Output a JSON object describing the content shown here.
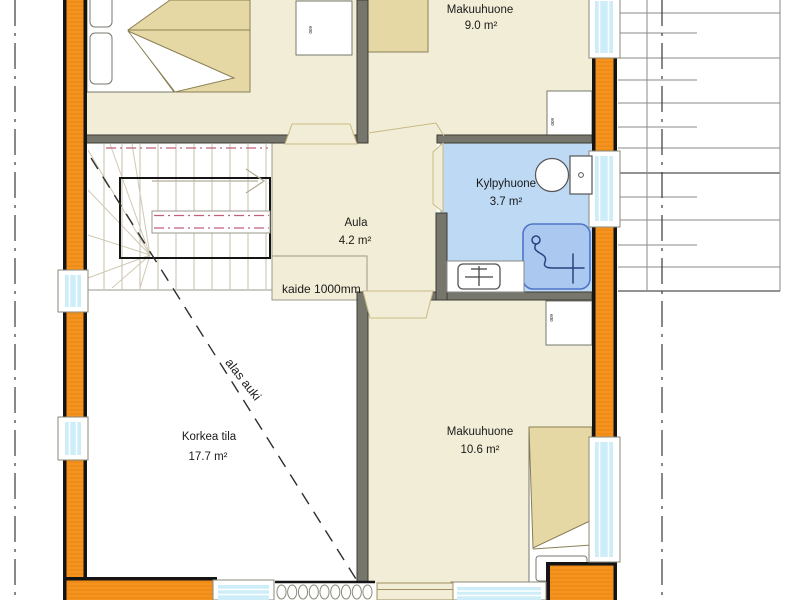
{
  "rooms": [
    {
      "name": "Makuuhuone",
      "area": "9.0 m²"
    },
    {
      "name": "Kylpyhuone",
      "area": "3.7 m²"
    },
    {
      "name": "Aula",
      "area": "4.2 m²"
    },
    {
      "name": "Korkea tila",
      "area": "17.7 m²"
    },
    {
      "name": "Makuuhuone",
      "area": "10.6 m²"
    }
  ],
  "annotations": {
    "railing": "kaide 1000mm",
    "open_below": "alas auki",
    "cabinet_tag": "600"
  },
  "colors": {
    "wall-orange": "#f6921e",
    "wall-black": "#141414",
    "interior-wall": "#76766c",
    "floor-cream": "#f2edd6",
    "floor-tan-edge": "#c9ba85",
    "bath-blue": "#bdd9f4",
    "shower-blue": "#abc8f0",
    "shower-border": "#4f74c8",
    "window-glass": "#cdeef8",
    "window-frame-line": "#8a8a78",
    "furniture-tan": "#e6d8a4",
    "furniture-edge": "#8a7f55",
    "stair-line": "#c6bfab",
    "rail-pink": "#c4607c",
    "roof-line": "#8a8a8a",
    "text": "#1a1a1a"
  }
}
